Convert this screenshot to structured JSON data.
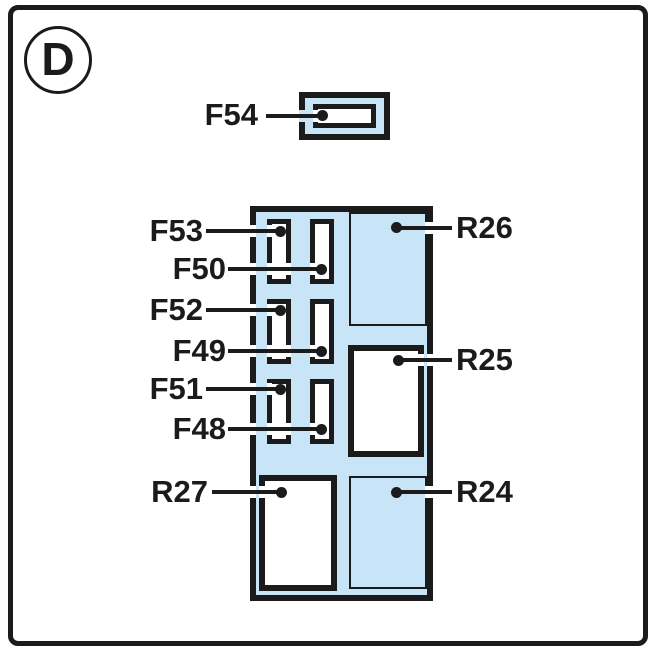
{
  "figure": {
    "marker_letter": "D"
  },
  "colors": {
    "panel_fill": "#c8e4f7",
    "slot_fill": "#ffffff",
    "ink": "#1b1b1b"
  },
  "fuses": {
    "f54": "F54",
    "f53": "F53",
    "f50": "F50",
    "f52": "F52",
    "f49": "F49",
    "f51": "F51",
    "f48": "F48"
  },
  "relays": {
    "r27": "R27",
    "r26": "R26",
    "r25": "R25",
    "r24": "R24"
  }
}
